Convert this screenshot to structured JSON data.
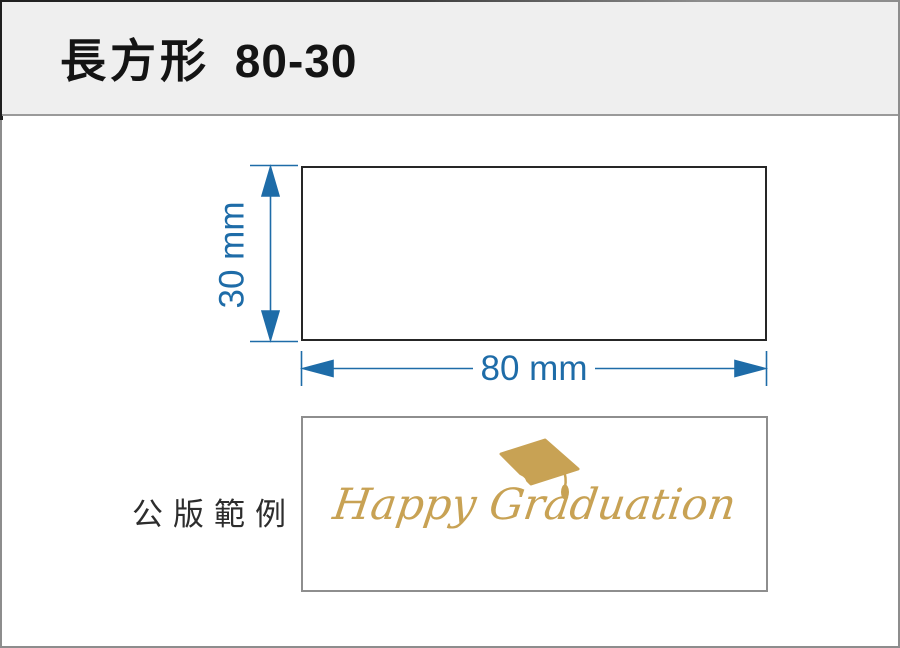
{
  "header": {
    "title_shape": "長方形",
    "title_size": "80-30"
  },
  "diagram": {
    "height_label": "30 mm",
    "width_label": "80 mm"
  },
  "sample": {
    "caption": "公版範例",
    "message": "Happy Graduation",
    "icon": "graduation-cap-icon"
  },
  "colors": {
    "dimension_blue": "#1E6CA8",
    "rect_border": "#262626",
    "gold": "#C8A254",
    "header_bg": "#EFEFEF",
    "frame_gray": "#8D8D8D"
  }
}
